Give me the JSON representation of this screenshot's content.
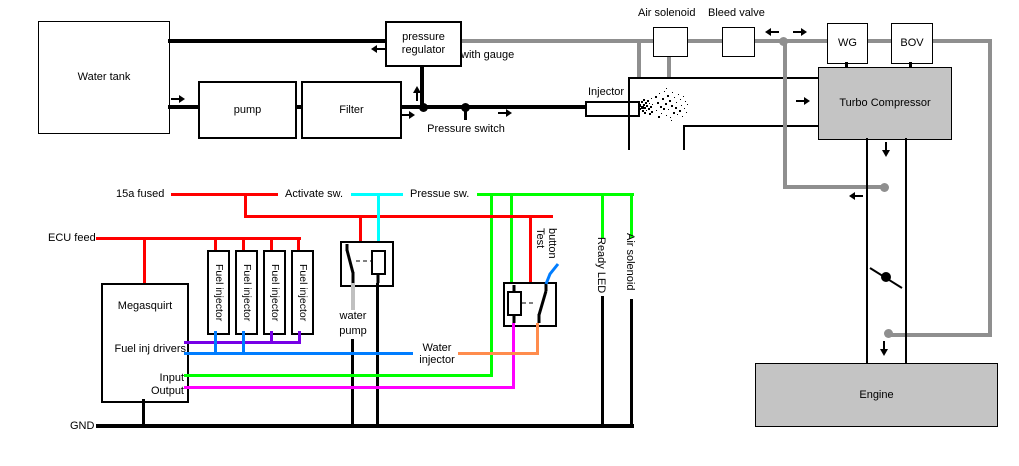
{
  "colors": {
    "wire_red": "#ff0000",
    "wire_cyan": "#00ffff",
    "wire_green": "#00ff00",
    "wire_magenta": "#ff00ff",
    "wire_blue": "#007dff",
    "wire_purple": "#7700e6",
    "wire_orange": "#ff8c4d",
    "wire_light_gray": "#c0c0c0",
    "air_line_gray": "#8f8f8f",
    "component_fill_gray": "#c4c4c4",
    "line_black": "#000000"
  },
  "flow": {
    "water_tank": "Water tank",
    "pump": "pump",
    "filter": "Filter",
    "pressure_regulator": "pressure regulator",
    "with_gauge": "with gauge",
    "pressure_switch": "Pressure switch",
    "injector": "Injector",
    "air_solenoid": "Air solenoid",
    "bleed_valve": "Bleed valve",
    "wastegate": "WG",
    "bov": "BOV",
    "turbo_compressor": "Turbo Compressor",
    "engine": "Engine"
  },
  "wiring": {
    "fused_15a": "15a fused",
    "activate_sw": "Activate sw.",
    "pressue_sw": "Pressue sw.",
    "ecu_feed": "ECU feed",
    "megasquirt": "Megasquirt",
    "fuel_inj_drivers": "Fuel inj drivers",
    "input": "Input",
    "output": "Output",
    "fuel_injectors": [
      "Fuel injector",
      "Fuel injector",
      "Fuel injector",
      "Fuel injector"
    ],
    "water_pump": "water pump",
    "water_injector": "Water injector",
    "test_button": "Test button",
    "ready_led": "Ready LED",
    "air_solenoid": "Air solenoid",
    "gnd": "GND"
  }
}
